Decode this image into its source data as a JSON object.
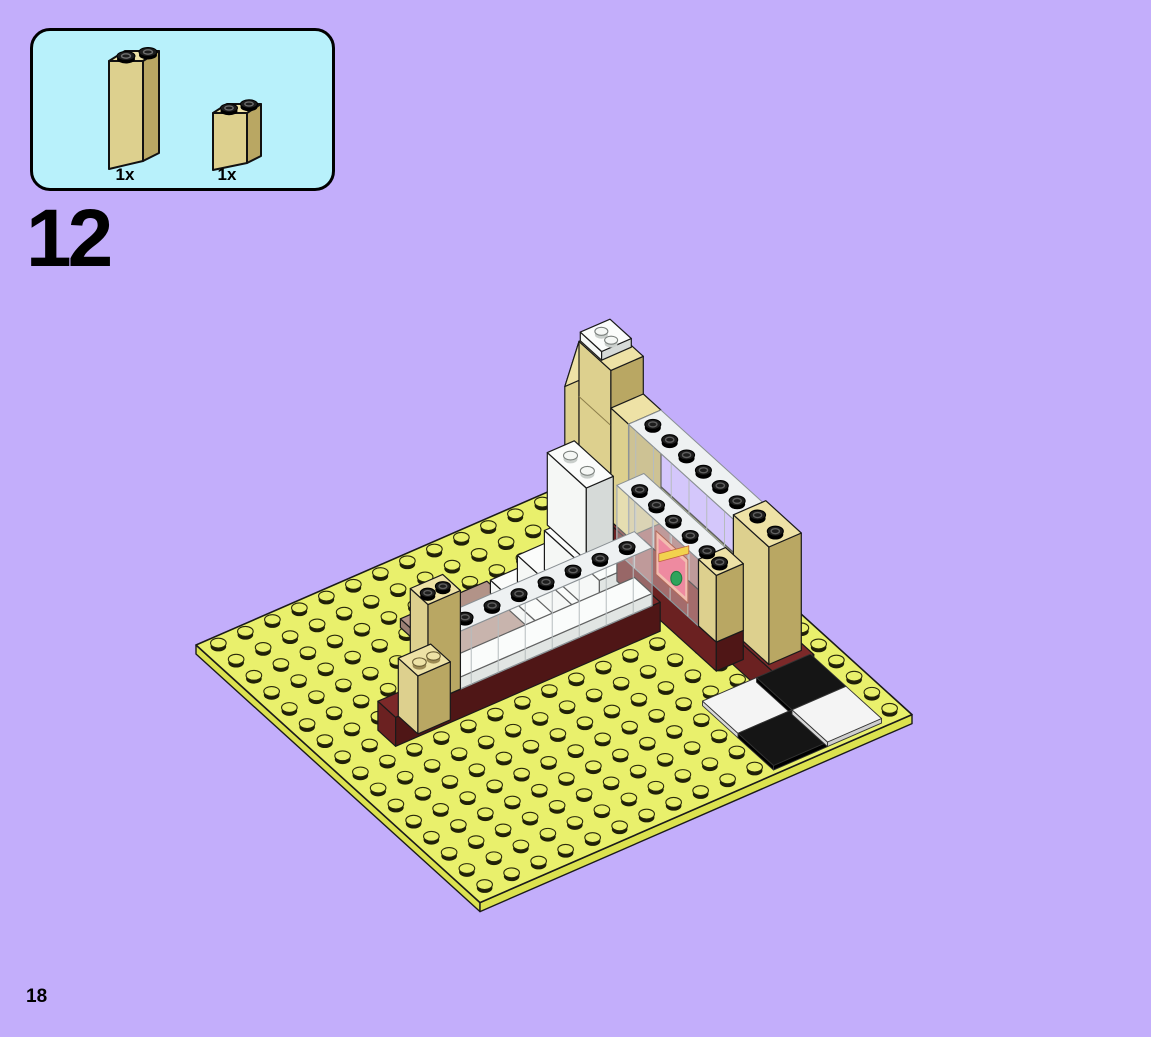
{
  "page": {
    "step_number": "12",
    "page_number": "18"
  },
  "parts_panel": {
    "items": [
      {
        "quantity": "1x",
        "part": "tan-brick-1x2x5"
      },
      {
        "quantity": "1x",
        "part": "tan-brick-1x2x2"
      }
    ]
  },
  "colors": {
    "background": "#c3aefb",
    "panel_bg": "#b8f1fb",
    "panel_border": "#000000",
    "baseplate": "#e9f06c",
    "baseplate_edge": "#dce24f",
    "stud_shadow": "#1f1f08",
    "tan": "#ddd08e",
    "tan_dark": "#b9a763",
    "tan_light": "#eee2a6",
    "dark_red": "#6b2121",
    "dark_red_dark": "#4f1616",
    "dark_red_top": "#7c2929",
    "black_stud": "#1d1d1d",
    "white": "#f5f7f5",
    "white_dark": "#d6dad8",
    "glass_frame": "#8e9498",
    "glass_fill": "#f8fbfc",
    "tile_white": "#f4f4f4",
    "tile_black": "#151515",
    "floor_rose": "#b29388",
    "sticker_border": "#f2bdb0",
    "sticker_pink": "#ee8aa0",
    "sticker_green": "#2fa45c",
    "sticker_yellow": "#f2d24e",
    "outline": "#1a1a1a",
    "text": "#000000"
  }
}
